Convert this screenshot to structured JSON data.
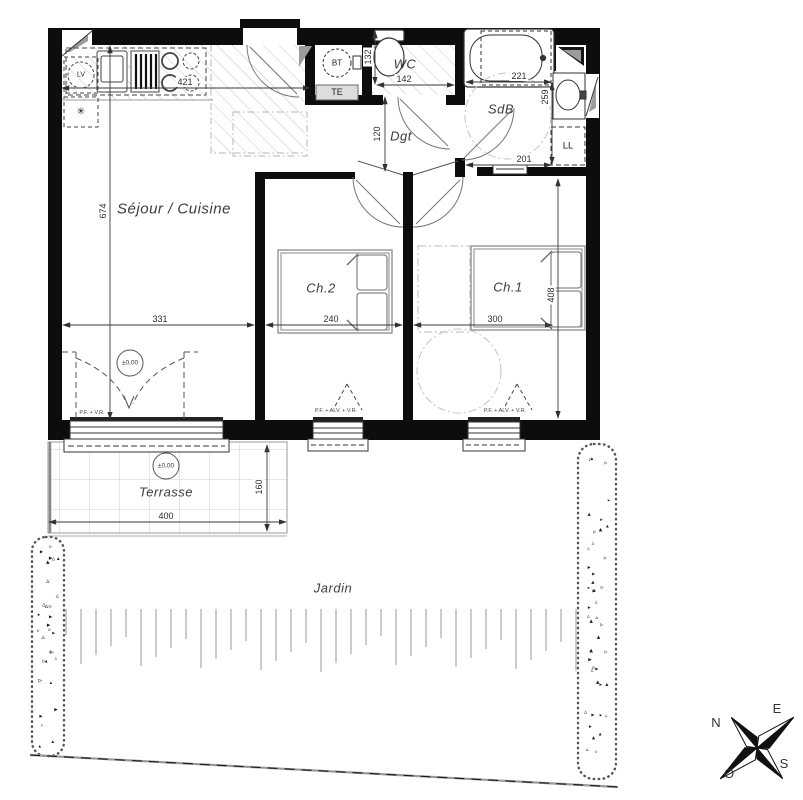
{
  "rooms": {
    "living": "Séjour / Cuisine",
    "hallway": "Dgt",
    "wc": "WC",
    "bathroom": "SdB",
    "bedroom2": "Ch.2",
    "bedroom1": "Ch.1",
    "terrace": "Terrasse",
    "garden": "Jardin"
  },
  "equipment": {
    "dishwasher": "LV",
    "water_heater": "BT",
    "te_box": "TE",
    "washing_machine": "LL",
    "fridge_symbol": "✳"
  },
  "levels": {
    "living_level": "±0,00",
    "terrace_level": "±0,00"
  },
  "windows": {
    "living_window": "P.F. + V.R.",
    "bedroom2_window": "P.F. + ALV. + V.R.",
    "bedroom1_window": "P.F. + ALV. + V.R."
  },
  "dimensions_cm": {
    "kitchen_top_width": "421",
    "living_height": "674",
    "living_width": "331",
    "bedroom2_width": "240",
    "bedroom1_width": "300",
    "bedroom1_height": "408",
    "hall_width": "120",
    "wc_depth": "132",
    "wc_width": "142",
    "bathroom_top_width": "221",
    "bathroom_height": "259",
    "bathroom_bottom_width": "201",
    "terrace_width": "400",
    "terrace_depth": "160"
  },
  "compass": {
    "north": "N",
    "east": "E",
    "south": "S",
    "west": "O"
  }
}
